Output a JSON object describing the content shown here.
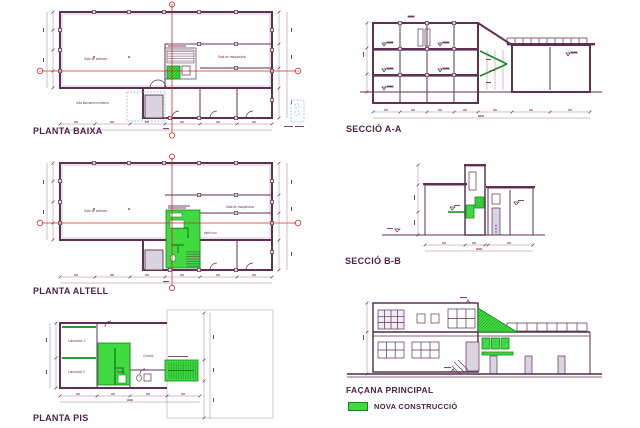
{
  "palette": {
    "wall": "#5e3152",
    "dark_line": "#4d2b45",
    "axis_red": "#d42b24",
    "new_green": "#3fd940",
    "green_dark": "#17861d",
    "dim_line": "#96718c",
    "light_line": "#bdb3c9",
    "blue_dashed": "#a9c3e8",
    "title_text": "#4f2340"
  },
  "drawings": {
    "planta_baixa": {
      "title": "PLANTA BAIXA",
      "axis_horizontal": "A",
      "axis_vertical": "B",
      "labels": {
        "left_room": "Sala de turbines",
        "right_room": "Sala de maquinària",
        "note_left": "línia tancament exterior"
      }
    },
    "seccio_aa": {
      "title": "SECCIÓ A-A"
    },
    "planta_altell": {
      "title": "PLANTA ALTELL",
      "labels": {
        "left_room": "Sala de turbines",
        "right_room": "Sala de maquinària",
        "mezzanine": "altell nou"
      }
    },
    "seccio_bb": {
      "title": "SECCIÓ B-B"
    },
    "planta_pis": {
      "title": "PLANTA PIS",
      "labels": {
        "lab1": "Laboratori 1",
        "lab2": "Laboratori 2",
        "control": "Control",
        "bany": "Bany"
      }
    },
    "facana": {
      "title": "FAÇANA PRINCIPAL"
    },
    "legend": {
      "label": "NOVA CONSTRUCCIÓ"
    }
  }
}
